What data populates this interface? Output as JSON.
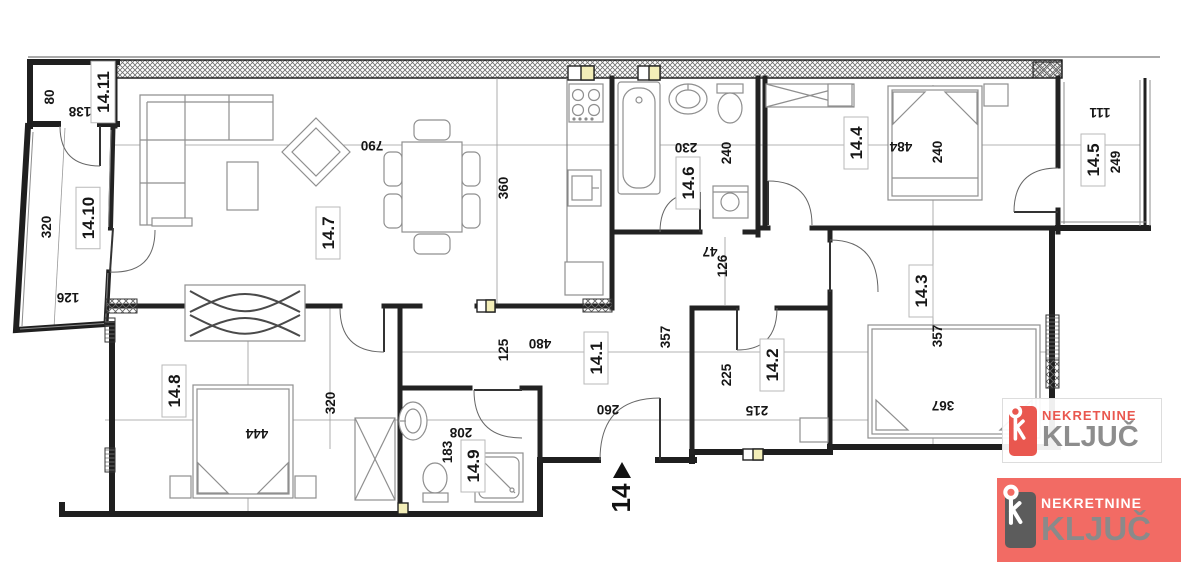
{
  "plan": {
    "entrance_number": "14",
    "labels": [
      {
        "t": "80",
        "x": 49,
        "y": 97,
        "r": -90
      },
      {
        "t": "138",
        "x": 80,
        "y": 112,
        "r": 180
      },
      {
        "t": "14.11",
        "x": 103,
        "y": 92,
        "r": -90,
        "room": true
      },
      {
        "t": "320",
        "x": 46,
        "y": 227,
        "r": -90
      },
      {
        "t": "14.10",
        "x": 88,
        "y": 218,
        "r": -90,
        "room": true
      },
      {
        "t": "126",
        "x": 68,
        "y": 298,
        "r": 180
      },
      {
        "t": "790",
        "x": 372,
        "y": 146,
        "r": 180
      },
      {
        "t": "14.7",
        "x": 328,
        "y": 233,
        "r": -90,
        "room": true
      },
      {
        "t": "360",
        "x": 503,
        "y": 188,
        "r": -90
      },
      {
        "t": "230",
        "x": 686,
        "y": 148,
        "r": 180
      },
      {
        "t": "240",
        "x": 726,
        "y": 153,
        "r": -90
      },
      {
        "t": "14.6",
        "x": 688,
        "y": 183,
        "r": -90,
        "room": true
      },
      {
        "t": "484",
        "x": 901,
        "y": 147,
        "r": 180
      },
      {
        "t": "240",
        "x": 937,
        "y": 152,
        "r": -90
      },
      {
        "t": "14.4",
        "x": 856,
        "y": 143,
        "r": -90,
        "room": true
      },
      {
        "t": "111",
        "x": 1100,
        "y": 113,
        "r": 180
      },
      {
        "t": "14.5",
        "x": 1093,
        "y": 160,
        "r": -90,
        "room": true
      },
      {
        "t": "249",
        "x": 1115,
        "y": 162,
        "r": -90
      },
      {
        "t": "47",
        "x": 710,
        "y": 252,
        "r": 180
      },
      {
        "t": "126",
        "x": 722,
        "y": 266,
        "r": -90
      },
      {
        "t": "125",
        "x": 503,
        "y": 350,
        "r": -90
      },
      {
        "t": "480",
        "x": 540,
        "y": 344,
        "r": 180
      },
      {
        "t": "14.1",
        "x": 596,
        "y": 358,
        "r": -90,
        "room": true
      },
      {
        "t": "357",
        "x": 665,
        "y": 337,
        "r": -90
      },
      {
        "t": "260",
        "x": 608,
        "y": 410,
        "r": 180
      },
      {
        "t": "225",
        "x": 726,
        "y": 375,
        "r": -90
      },
      {
        "t": "14.2",
        "x": 772,
        "y": 365,
        "r": -90,
        "room": true
      },
      {
        "t": "215",
        "x": 757,
        "y": 411,
        "r": 180
      },
      {
        "t": "14.3",
        "x": 921,
        "y": 291,
        "r": -90,
        "room": true
      },
      {
        "t": "357",
        "x": 937,
        "y": 336,
        "r": -90
      },
      {
        "t": "367",
        "x": 943,
        "y": 406,
        "r": 180
      },
      {
        "t": "14.8",
        "x": 174,
        "y": 391,
        "r": -90,
        "room": true
      },
      {
        "t": "444",
        "x": 257,
        "y": 434,
        "r": 180
      },
      {
        "t": "320",
        "x": 330,
        "y": 403,
        "r": -90
      },
      {
        "t": "183",
        "x": 447,
        "y": 452,
        "r": -90
      },
      {
        "t": "208",
        "x": 461,
        "y": 433,
        "r": 180
      },
      {
        "t": "14.9",
        "x": 473,
        "y": 466,
        "r": -90,
        "room": true
      }
    ]
  },
  "watermarks": {
    "light": {
      "name": "NEKRETNINE",
      "word": "KLJUČ"
    },
    "red": {
      "name": "NEKRETNINE",
      "word": "KLJUČ"
    }
  },
  "colors": {
    "logo_red": "#e9574f",
    "logo_red_bg": "#f26b64",
    "logo_gray": "#8d8d8d",
    "vent_yellow": "#f3eeb8"
  }
}
